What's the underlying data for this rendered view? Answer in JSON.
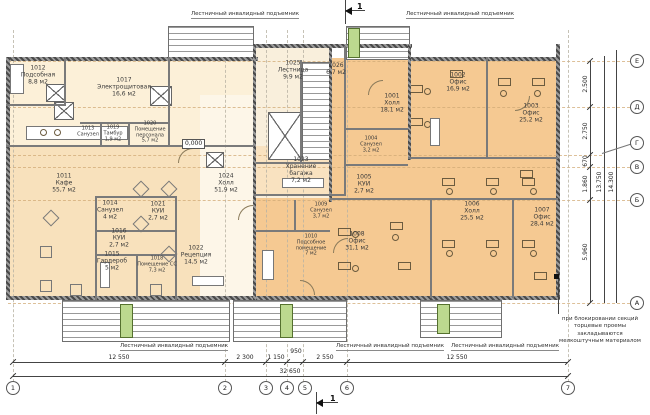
{
  "drawing": {
    "rooms": [
      {
        "id": "1012",
        "name": "Подсобная",
        "area": "8,8 м2"
      },
      {
        "id": "1017",
        "name": "Электрощитовая",
        "area": "16,6 м2"
      },
      {
        "id": "1013",
        "name": "Санузел",
        "area": ""
      },
      {
        "id": "1019",
        "name": "Тамбур",
        "area": "1,9 м2"
      },
      {
        "id": "1020",
        "name": "Помещение персонала",
        "area": "5,7 м2"
      },
      {
        "id": "1011",
        "name": "Кафе",
        "area": "55,7 м2"
      },
      {
        "id": "1014",
        "name": "Санузел",
        "area": "4 м2"
      },
      {
        "id": "1021",
        "name": "КУИ",
        "area": "2,7 м2"
      },
      {
        "id": "1016",
        "name": "КУИ",
        "area": "2,7 м2"
      },
      {
        "id": "1015",
        "name": "Гардероб",
        "area": "5 м2"
      },
      {
        "id": "1018",
        "name": "Помещение СС",
        "area": "7,3 м2"
      },
      {
        "id": "1022",
        "name": "Рецепция",
        "area": "14,5 м2"
      },
      {
        "id": "1024",
        "name": "Холл",
        "area": "51,9 м2"
      },
      {
        "id": "1023",
        "name": "Хранение багажа",
        "area": "7,2 м2"
      },
      {
        "id": "1025",
        "name": "Лестница",
        "area": "9,9 м2"
      },
      {
        "id": "1026",
        "name": "",
        "area": "6,7 м2"
      },
      {
        "id": "1001",
        "name": "Холл",
        "area": "18,1 м2"
      },
      {
        "id": "1002",
        "name": "Офис",
        "area": "16,9 м2"
      },
      {
        "id": "1003",
        "name": "Офис",
        "area": "25,2 м2"
      },
      {
        "id": "1004",
        "name": "Санузел",
        "area": "3,2 м2"
      },
      {
        "id": "1005",
        "name": "КУИ",
        "area": "2,7 м2"
      },
      {
        "id": "1006",
        "name": "Холл",
        "area": "25,5 м2"
      },
      {
        "id": "1007",
        "name": "Офис",
        "area": "28,4 м2"
      },
      {
        "id": "1008",
        "name": "Офис",
        "area": "31,1 м2"
      },
      {
        "id": "1009",
        "name": "Санузел",
        "area": "3,7 м2"
      },
      {
        "id": "1010",
        "name": "Подсобное помещение",
        "area": "7 м2"
      }
    ],
    "annotations": {
      "lift_label": "Лестничный инвалидный подъемник",
      "note_lines": [
        "при блокировании секций",
        "торцевые проемы закладываются",
        "мелкоштучным материалом"
      ],
      "elevation_mark": "0,000",
      "section_mark": "1"
    },
    "dimensions": {
      "bottom_segments": [
        "12 550",
        "2 300",
        "1 150",
        "950",
        "2 550",
        "12 550"
      ],
      "bottom_total": "32 650",
      "right_segments": [
        "2.500",
        "2.750",
        "670",
        "1.860",
        "5.960"
      ],
      "right_totals": [
        "13.750",
        "14.300"
      ],
      "axes_bottom": [
        "1",
        "2",
        "3",
        "4",
        "5",
        "6",
        "7"
      ],
      "axes_right": [
        "Е",
        "Д",
        "Г",
        "В",
        "Б",
        "А"
      ]
    },
    "colors": {
      "left_section": "#fcf0d8",
      "cafe": "#f8e1bc",
      "hall": "#fdf6e8",
      "right_section": "#f5c992",
      "lift": "#bcd98f",
      "wall": "#4f4f4f"
    }
  }
}
